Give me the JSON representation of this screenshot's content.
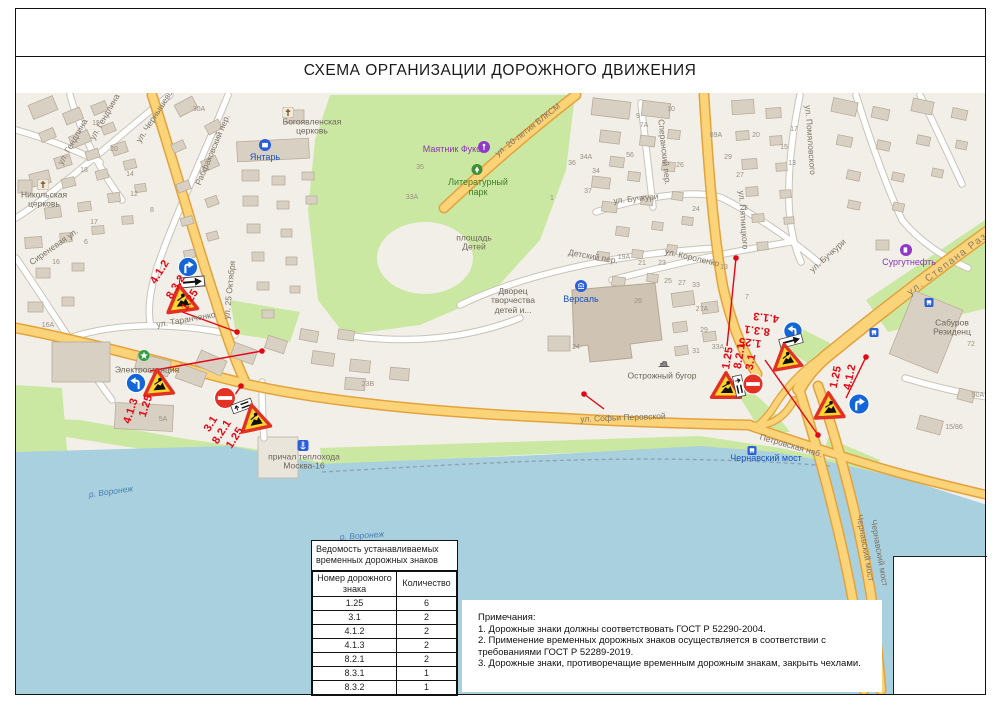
{
  "page": {
    "title": "СХЕМА ОРГАНИЗАЦИИ ДОРОЖНОГО ДВИЖЕНИЯ"
  },
  "legend_table": {
    "title": "Ведомость устанавливаемых временных дорожных знаков",
    "columns": [
      "Номер дорожного знака",
      "Количество"
    ],
    "rows": [
      [
        "1.25",
        "6"
      ],
      [
        "3.1",
        "2"
      ],
      [
        "4.1.2",
        "2"
      ],
      [
        "4.1.3",
        "2"
      ],
      [
        "8.2.1",
        "2"
      ],
      [
        "8.3.1",
        "1"
      ],
      [
        "8.3.2",
        "1"
      ]
    ]
  },
  "notes": {
    "heading": "Примечания:",
    "items": [
      "1. Дорожные знаки должны соответствовать ГОСТ Р 52290-2004.",
      "2. Применение временных дорожных знаков осуществляется в соответствии с требованиями ГОСТ Р 52289-2019.",
      "3. Дорожные знаки, противоречащие временным дорожным знакам, закрыть чехлами."
    ]
  },
  "map": {
    "colors": {
      "water": "#a8d0de",
      "park_green": "#cbe8a2",
      "road_major": "#fbd378",
      "road_casing": "#e2a33c",
      "building": "#d9d0c4",
      "annotation_red": "#e30613",
      "sign_yellow": "#ffd52e",
      "sign_blue": "#1466d8"
    },
    "labels": [
      {
        "t": "ул. Чернышевского",
        "x": 143,
        "y": 110,
        "r": -57,
        "c": "street"
      },
      {
        "t": "ул. Гендлина",
        "x": 57,
        "y": 142,
        "r": -60,
        "c": "street"
      },
      {
        "t": "ул. Гендлина",
        "x": 89,
        "y": 117,
        "r": -60,
        "c": "street"
      },
      {
        "t": "Рабфаковский пер.",
        "x": 197,
        "y": 150,
        "r": -67,
        "c": "street"
      },
      {
        "t": "ул. 25 Октября",
        "x": 214,
        "y": 290,
        "r": -84,
        "c": "street"
      },
      {
        "t": "ул. Таранченко",
        "x": 170,
        "y": 320,
        "r": -10,
        "c": "street"
      },
      {
        "t": "Сиреневая ул.",
        "x": 38,
        "y": 247,
        "r": -35,
        "c": "street"
      },
      {
        "t": "ул. 20-летия ВЛКСМ",
        "x": 512,
        "y": 130,
        "r": -38,
        "c": "street"
      },
      {
        "t": "Сперанский пер.",
        "x": 648,
        "y": 152,
        "r": 84,
        "c": "street"
      },
      {
        "t": "ул. Бучкури",
        "x": 620,
        "y": 199,
        "r": -6,
        "c": "street"
      },
      {
        "t": "ул. Бучкури",
        "x": 812,
        "y": 256,
        "r": -42,
        "c": "street"
      },
      {
        "t": "ул. Пятницкого",
        "x": 727,
        "y": 220,
        "r": 86,
        "c": "street"
      },
      {
        "t": "ул. Помяловского",
        "x": 794,
        "y": 140,
        "r": 86,
        "c": "street"
      },
      {
        "t": "ул. Короленко",
        "x": 676,
        "y": 258,
        "r": 13,
        "c": "street"
      },
      {
        "t": "Детский пер.",
        "x": 577,
        "y": 257,
        "r": 10,
        "c": "street"
      },
      {
        "t": "ул. Степана Разина",
        "x": 940,
        "y": 258,
        "r": -37,
        "c": "streetbig"
      },
      {
        "t": "ул. Софьи Перовской",
        "x": 607,
        "y": 418,
        "r": -2,
        "c": "street"
      },
      {
        "t": "Петровская наб.",
        "x": 775,
        "y": 446,
        "r": 16,
        "c": "street"
      },
      {
        "t": "Чернавский мост",
        "x": 849,
        "y": 548,
        "r": 80,
        "c": "street"
      },
      {
        "t": "Чернавский мост",
        "x": 863,
        "y": 553,
        "r": 80,
        "c": "street"
      },
      {
        "t": "Чернавский мост",
        "x": 750,
        "y": 459,
        "r": 0,
        "c": "bluelabel"
      },
      {
        "t": "Маятник Фуко",
        "x": 436,
        "y": 150,
        "r": 0,
        "c": "purple"
      },
      {
        "t": "Литературный\nпарк",
        "x": 462,
        "y": 188,
        "r": 0,
        "c": "park"
      },
      {
        "t": "площадь\nДетей",
        "x": 458,
        "y": 243,
        "r": 0,
        "c": "place"
      },
      {
        "t": "Дворец\nтворчества\nдетей и...",
        "x": 497,
        "y": 301,
        "r": 0,
        "c": "place"
      },
      {
        "t": "Версаль",
        "x": 565,
        "y": 300,
        "r": 0,
        "c": "bluelabel"
      },
      {
        "t": "Острожный бугор",
        "x": 646,
        "y": 376,
        "r": 0,
        "c": "place"
      },
      {
        "t": "Электростанция",
        "x": 131,
        "y": 370,
        "r": 0,
        "c": "place"
      },
      {
        "t": "Янтарь",
        "x": 249,
        "y": 158,
        "r": 0,
        "c": "bluelabel"
      },
      {
        "t": "Богоявленская\nцерковь",
        "x": 296,
        "y": 127,
        "r": 0,
        "c": "place"
      },
      {
        "t": "Никольская\nцерковь",
        "x": 28,
        "y": 200,
        "r": 0,
        "c": "place"
      },
      {
        "t": "Сургутнефть",
        "x": 893,
        "y": 263,
        "r": 0,
        "c": "purple"
      },
      {
        "t": "Сабуров\nРезиденц",
        "x": 936,
        "y": 328,
        "r": 0,
        "c": "place"
      },
      {
        "t": "причал теплохода\nМосква-16",
        "x": 288,
        "y": 462,
        "r": 0,
        "c": "place"
      },
      {
        "t": "р. Воронеж",
        "x": 95,
        "y": 492,
        "r": -8,
        "c": "water"
      },
      {
        "t": "р. Воронеж",
        "x": 346,
        "y": 536,
        "r": -4,
        "c": "water"
      }
    ],
    "building_numbers": [
      {
        "t": "15",
        "x": 80,
        "y": 124
      },
      {
        "t": "20",
        "x": 98,
        "y": 150
      },
      {
        "t": "18",
        "x": 68,
        "y": 171
      },
      {
        "t": "14",
        "x": 114,
        "y": 175
      },
      {
        "t": "12",
        "x": 118,
        "y": 195
      },
      {
        "t": "8",
        "x": 136,
        "y": 211
      },
      {
        "t": "17",
        "x": 78,
        "y": 223
      },
      {
        "t": "6",
        "x": 70,
        "y": 243
      },
      {
        "t": "16",
        "x": 40,
        "y": 263
      },
      {
        "t": "16А",
        "x": 32,
        "y": 326
      },
      {
        "t": "5А",
        "x": 147,
        "y": 420
      },
      {
        "t": "30А",
        "x": 183,
        "y": 110
      },
      {
        "t": "10",
        "x": 655,
        "y": 110
      },
      {
        "t": "9",
        "x": 622,
        "y": 117
      },
      {
        "t": "7А",
        "x": 628,
        "y": 126
      },
      {
        "t": "56",
        "x": 614,
        "y": 156
      },
      {
        "t": "26",
        "x": 664,
        "y": 166
      },
      {
        "t": "89А",
        "x": 700,
        "y": 136
      },
      {
        "t": "29",
        "x": 712,
        "y": 158
      },
      {
        "t": "20",
        "x": 740,
        "y": 136
      },
      {
        "t": "17",
        "x": 778,
        "y": 130
      },
      {
        "t": "15",
        "x": 768,
        "y": 148
      },
      {
        "t": "13",
        "x": 776,
        "y": 164
      },
      {
        "t": "27",
        "x": 724,
        "y": 176
      },
      {
        "t": "24",
        "x": 680,
        "y": 210
      },
      {
        "t": "23",
        "x": 728,
        "y": 209
      },
      {
        "t": "19А",
        "x": 608,
        "y": 258
      },
      {
        "t": "21",
        "x": 626,
        "y": 264
      },
      {
        "t": "23",
        "x": 646,
        "y": 264
      },
      {
        "t": "25",
        "x": 652,
        "y": 282
      },
      {
        "t": "27",
        "x": 666,
        "y": 284
      },
      {
        "t": "33",
        "x": 680,
        "y": 286
      },
      {
        "t": "13",
        "x": 708,
        "y": 268
      },
      {
        "t": "26",
        "x": 622,
        "y": 302
      },
      {
        "t": "24",
        "x": 560,
        "y": 348
      },
      {
        "t": "27А",
        "x": 686,
        "y": 310
      },
      {
        "t": "29",
        "x": 688,
        "y": 331
      },
      {
        "t": "31",
        "x": 680,
        "y": 352
      },
      {
        "t": "33А",
        "x": 702,
        "y": 348
      },
      {
        "t": "7",
        "x": 731,
        "y": 298
      },
      {
        "t": "35",
        "x": 404,
        "y": 168
      },
      {
        "t": "33А",
        "x": 396,
        "y": 198
      },
      {
        "t": "34А",
        "x": 570,
        "y": 158
      },
      {
        "t": "36",
        "x": 556,
        "y": 164
      },
      {
        "t": "34",
        "x": 580,
        "y": 172
      },
      {
        "t": "37",
        "x": 572,
        "y": 192
      },
      {
        "t": "1",
        "x": 536,
        "y": 199
      },
      {
        "t": "23В",
        "x": 352,
        "y": 385
      },
      {
        "t": "72",
        "x": 955,
        "y": 345
      },
      {
        "t": "50А",
        "x": 962,
        "y": 396
      },
      {
        "t": "15/86",
        "x": 938,
        "y": 428
      }
    ],
    "poi_icons": [
      {
        "icon": "church-icon",
        "x": 272,
        "y": 114
      },
      {
        "icon": "church-icon",
        "x": 27,
        "y": 186
      },
      {
        "icon": "factory-icon",
        "x": 249,
        "y": 147
      },
      {
        "icon": "museum-icon",
        "x": 565,
        "y": 288
      },
      {
        "icon": "fuel-icon",
        "x": 890,
        "y": 252
      },
      {
        "icon": "pendulum-icon",
        "x": 468,
        "y": 149
      },
      {
        "icon": "tree-icon",
        "x": 461,
        "y": 171
      },
      {
        "icon": "star-icon",
        "x": 128,
        "y": 357
      },
      {
        "icon": "anchor-icon",
        "x": 287,
        "y": 447
      },
      {
        "icon": "bus-stop-icon",
        "x": 736,
        "y": 451
      },
      {
        "icon": "bus-stop-icon",
        "x": 858,
        "y": 333
      },
      {
        "icon": "bus-stop-icon",
        "x": 913,
        "y": 303
      },
      {
        "icon": "monument-icon",
        "x": 648,
        "y": 364
      }
    ],
    "sign_clusters": [
      {
        "name": "cluster-25-oktyabrya",
        "signs": [
          {
            "code": "4.1.2",
            "x": 172,
            "y": 267,
            "s": 21,
            "r": 0
          },
          {
            "code": "8.3.2",
            "x": 176,
            "y": 282,
            "s": 26,
            "r": -5
          },
          {
            "code": "1.25",
            "x": 165,
            "y": 298,
            "s": 33,
            "r": -8
          }
        ],
        "labels": [
          {
            "t": "4.1.2",
            "x": 144,
            "y": 272,
            "r": -58
          },
          {
            "t": "8.3.2",
            "x": 160,
            "y": 287,
            "r": -58
          },
          {
            "t": "1.25",
            "x": 174,
            "y": 300,
            "r": -58
          }
        ]
      },
      {
        "name": "cluster-elektrostancia",
        "signs": [
          {
            "code": "4.1.3",
            "x": 120,
            "y": 383,
            "s": 21,
            "r": 0
          },
          {
            "code": "1.25",
            "x": 142,
            "y": 382,
            "s": 32,
            "r": -5
          }
        ],
        "labels": [
          {
            "t": "1.25",
            "x": 130,
            "y": 406,
            "r": -72
          },
          {
            "t": "4.1.3",
            "x": 115,
            "y": 411,
            "r": -72
          }
        ]
      },
      {
        "name": "cluster-perovskoy-west",
        "signs": [
          {
            "code": "3.1",
            "x": 209,
            "y": 398,
            "s": 23,
            "r": 0
          },
          {
            "code": "8.2.1",
            "x": 226,
            "y": 406,
            "s": 22,
            "r": -20
          },
          {
            "code": "1.25",
            "x": 238,
            "y": 417,
            "s": 32,
            "r": -12
          }
        ],
        "labels": [
          {
            "t": "3.1",
            "x": 195,
            "y": 424,
            "r": -58
          },
          {
            "t": "8.2.1",
            "x": 206,
            "y": 432,
            "r": -58
          },
          {
            "t": "1.25",
            "x": 219,
            "y": 438,
            "r": -58
          }
        ]
      },
      {
        "name": "cluster-perovskoy-east",
        "signs": [
          {
            "code": "1.25",
            "x": 710,
            "y": 385,
            "s": 32,
            "r": 0
          },
          {
            "code": "8.2.1",
            "x": 723,
            "y": 386,
            "s": 22,
            "r": 78
          },
          {
            "code": "3.1",
            "x": 737,
            "y": 384,
            "s": 22,
            "r": 0
          }
        ],
        "labels": [
          {
            "t": "1.25",
            "x": 712,
            "y": 358,
            "r": -80
          },
          {
            "t": "8.2.1",
            "x": 724,
            "y": 356,
            "r": -80
          },
          {
            "t": "3.1",
            "x": 735,
            "y": 362,
            "r": -80
          }
        ]
      },
      {
        "name": "cluster-bridgehead",
        "signs": [
          {
            "code": "4.1.3",
            "x": 777,
            "y": 331,
            "s": 20,
            "r": 0
          },
          {
            "code": "8.3.1",
            "x": 775,
            "y": 341,
            "s": 24,
            "r": -15
          },
          {
            "code": "1.25",
            "x": 770,
            "y": 356,
            "s": 31,
            "r": -10
          }
        ],
        "labels": [
          {
            "t": "4.1.3",
            "x": 750,
            "y": 317,
            "r": 187
          },
          {
            "t": "8.3.1",
            "x": 741,
            "y": 330,
            "r": 187
          },
          {
            "t": "1.25",
            "x": 734,
            "y": 342,
            "r": 187
          }
        ]
      },
      {
        "name": "cluster-stepana-razina",
        "signs": [
          {
            "code": "1.25",
            "x": 813,
            "y": 405,
            "s": 32,
            "r": -3
          },
          {
            "code": "4.1.2",
            "x": 843,
            "y": 404,
            "s": 22,
            "r": 0
          }
        ],
        "labels": [
          {
            "t": "1.25",
            "x": 820,
            "y": 377,
            "r": -78
          },
          {
            "t": "4.1.2",
            "x": 834,
            "y": 377,
            "r": -78
          }
        ]
      }
    ]
  }
}
